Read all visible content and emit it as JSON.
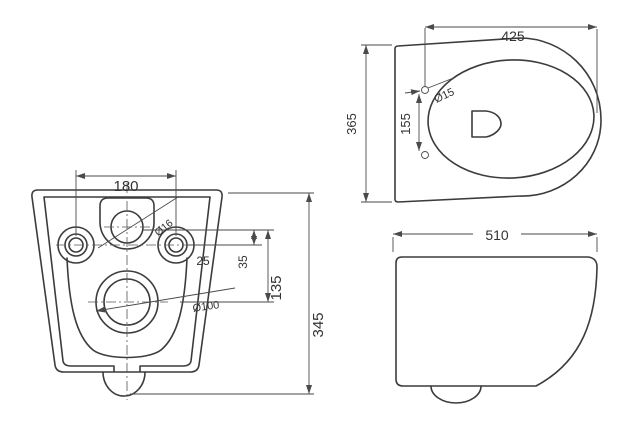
{
  "document": {
    "type": "technical-dimension-drawing",
    "subject": "wall-hung toilet, three orthographic views"
  },
  "views": {
    "front": {
      "dim_hole_spacing": "180",
      "dia_mounting_hole": "Ø16",
      "dim_offset_25": "25",
      "dim_offset_35": "35",
      "dim_height_135": "135",
      "dia_drain": "Ø100",
      "dim_total_height": "345"
    },
    "top": {
      "dim_depth": "425",
      "dia_seat_hole": "Ø15",
      "dim_seat_hole_spacing": "155",
      "dim_width": "365"
    },
    "side": {
      "dim_total_depth": "510"
    }
  },
  "colors": {
    "background": "#ffffff",
    "line": "#3c3c3c",
    "dimension_line": "#4a4a4a",
    "text": "#333333"
  }
}
